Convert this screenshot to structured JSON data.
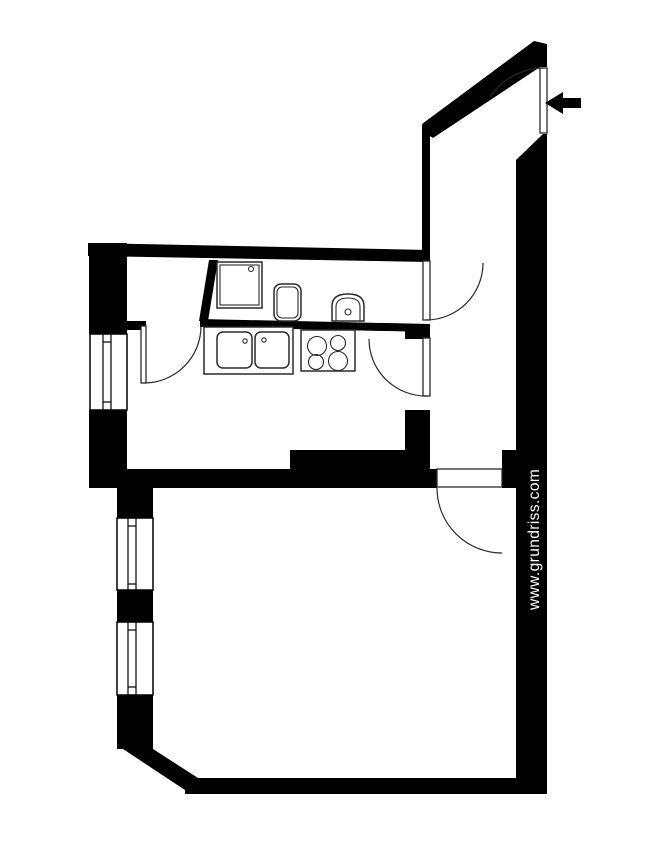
{
  "colors": {
    "wall": "#000000",
    "line": "#2a2a2a",
    "background": "#ffffff",
    "watermark": "#ffffff"
  },
  "watermark": {
    "text": "www.grundriss.com"
  },
  "canvas": {
    "width": 650,
    "height": 856
  },
  "shapes": [
    {
      "name": "top-wall",
      "type": "polygon",
      "cls": "wall",
      "attrs": {
        "points": "88,243 430,250 430,262 88,256"
      }
    },
    {
      "name": "left-wall-upper",
      "type": "rect",
      "cls": "wall",
      "attrs": {
        "x": 89,
        "y": 243,
        "width": 38,
        "height": 91
      }
    },
    {
      "name": "left-wall-mid",
      "type": "rect",
      "cls": "wall",
      "attrs": {
        "x": 89,
        "y": 410,
        "width": 38,
        "height": 78
      }
    },
    {
      "name": "pantry-bottom-wall",
      "type": "rect",
      "cls": "wall",
      "attrs": {
        "x": 117,
        "y": 321,
        "width": 29,
        "height": 9
      }
    },
    {
      "name": "bath-kitchen-wall",
      "type": "polygon",
      "cls": "wall",
      "attrs": {
        "points": "200,319 430,324 430,332 200,327"
      }
    },
    {
      "name": "pantry-bath-divider",
      "type": "polygon",
      "cls": "wall",
      "attrs": {
        "points": "209,260 218,260 208,321 199,321"
      }
    },
    {
      "name": "hall-left-wall",
      "type": "rect",
      "cls": "wall",
      "attrs": {
        "x": 422,
        "y": 125,
        "width": 8,
        "height": 127
      }
    },
    {
      "name": "hall-mid-stub",
      "type": "rect",
      "cls": "wall",
      "attrs": {
        "x": 405,
        "y": 325,
        "width": 25,
        "height": 14
      }
    },
    {
      "name": "kitchen-hall-wall",
      "type": "rect",
      "cls": "wall",
      "attrs": {
        "x": 405,
        "y": 410,
        "width": 25,
        "height": 60
      }
    },
    {
      "name": "chimney-block",
      "type": "rect",
      "cls": "wall",
      "attrs": {
        "x": 290,
        "y": 450,
        "width": 140,
        "height": 20
      }
    },
    {
      "name": "room-top-wall",
      "type": "rect",
      "cls": "wall",
      "attrs": {
        "x": 117,
        "y": 469,
        "width": 320,
        "height": 19
      }
    },
    {
      "name": "room-door-right-stub",
      "type": "rect",
      "cls": "wall",
      "attrs": {
        "x": 502,
        "y": 450,
        "width": 14,
        "height": 38
      }
    },
    {
      "name": "right-wall",
      "type": "polygon",
      "cls": "wall",
      "attrs": {
        "points": "543,134 547,134 547,793 516,793 516,160"
      }
    },
    {
      "name": "diagonal-entrance-wall",
      "type": "polygon",
      "cls": "wall",
      "attrs": {
        "points": "534,41 547,44 547,67 540,67 433,138 422,131 422,124"
      }
    },
    {
      "name": "room-left-wall",
      "type": "rect",
      "cls": "wall",
      "attrs": {
        "x": 117,
        "y": 469,
        "width": 36,
        "height": 280
      }
    },
    {
      "name": "chamfer-wall",
      "type": "polygon",
      "cls": "wall",
      "attrs": {
        "points": "117,736 153,736 153,749 198,778 191,794 117,745"
      }
    },
    {
      "name": "bottom-wall",
      "type": "rect",
      "cls": "wall",
      "attrs": {
        "x": 185,
        "y": 778,
        "width": 362,
        "height": 16
      }
    },
    {
      "name": "kitchen-window-frame",
      "type": "rect",
      "cls": "win",
      "attrs": {
        "x": 90,
        "y": 334,
        "width": 37,
        "height": 76
      }
    },
    {
      "name": "kitchen-window-pane-1",
      "type": "line",
      "cls": "wline",
      "attrs": {
        "x1": 103,
        "y1": 334,
        "x2": 103,
        "y2": 410
      }
    },
    {
      "name": "kitchen-window-pane-2",
      "type": "line",
      "cls": "wline",
      "attrs": {
        "x1": 111,
        "y1": 334,
        "x2": 111,
        "y2": 410
      }
    },
    {
      "name": "kitchen-window-tick-1",
      "type": "line",
      "cls": "wline",
      "attrs": {
        "x1": 103,
        "y1": 342,
        "x2": 111,
        "y2": 342
      }
    },
    {
      "name": "kitchen-window-tick-2",
      "type": "line",
      "cls": "wline",
      "attrs": {
        "x1": 103,
        "y1": 402,
        "x2": 111,
        "y2": 402
      }
    },
    {
      "name": "room-window-1-frame",
      "type": "rect",
      "cls": "win",
      "attrs": {
        "x": 117,
        "y": 518,
        "width": 36,
        "height": 72
      }
    },
    {
      "name": "room-window-1-pane-1",
      "type": "line",
      "cls": "wline",
      "attrs": {
        "x1": 128,
        "y1": 518,
        "x2": 128,
        "y2": 590
      }
    },
    {
      "name": "room-window-1-pane-2",
      "type": "line",
      "cls": "wline",
      "attrs": {
        "x1": 136,
        "y1": 518,
        "x2": 136,
        "y2": 590
      }
    },
    {
      "name": "room-window-1-tick-1",
      "type": "line",
      "cls": "wline",
      "attrs": {
        "x1": 128,
        "y1": 526,
        "x2": 136,
        "y2": 526
      }
    },
    {
      "name": "room-window-1-tick-2",
      "type": "line",
      "cls": "wline",
      "attrs": {
        "x1": 128,
        "y1": 584,
        "x2": 136,
        "y2": 584
      }
    },
    {
      "name": "room-window-2-frame",
      "type": "rect",
      "cls": "win",
      "attrs": {
        "x": 117,
        "y": 622,
        "width": 36,
        "height": 73
      }
    },
    {
      "name": "room-window-2-pane-1",
      "type": "line",
      "cls": "wline",
      "attrs": {
        "x1": 128,
        "y1": 622,
        "x2": 128,
        "y2": 695
      }
    },
    {
      "name": "room-window-2-pane-2",
      "type": "line",
      "cls": "wline",
      "attrs": {
        "x1": 136,
        "y1": 622,
        "x2": 136,
        "y2": 695
      }
    },
    {
      "name": "room-window-2-tick-1",
      "type": "line",
      "cls": "wline",
      "attrs": {
        "x1": 128,
        "y1": 630,
        "x2": 136,
        "y2": 630
      }
    },
    {
      "name": "room-window-2-tick-2",
      "type": "line",
      "cls": "wline",
      "attrs": {
        "x1": 128,
        "y1": 687,
        "x2": 136,
        "y2": 687
      }
    },
    {
      "name": "entrance-door-leaf",
      "type": "rect",
      "cls": "leaf",
      "attrs": {
        "x": 540,
        "y": 68,
        "width": 7,
        "height": 65
      }
    },
    {
      "name": "entrance-door-arc",
      "type": "path",
      "cls": "arc",
      "attrs": {
        "d": "M543,68 A65,65 0 0 0 490,97"
      }
    },
    {
      "name": "bath-door-leaf",
      "type": "rect",
      "cls": "leaf",
      "attrs": {
        "x": 423,
        "y": 261,
        "width": 7,
        "height": 59
      }
    },
    {
      "name": "bath-door-arc",
      "type": "path",
      "cls": "arc",
      "attrs": {
        "d": "M426,320 A57,57 0 0 0 483,263"
      }
    },
    {
      "name": "kitchen-door-leaf",
      "type": "rect",
      "cls": "leaf",
      "attrs": {
        "x": 423,
        "y": 338,
        "width": 7,
        "height": 58
      }
    },
    {
      "name": "kitchen-door-arc",
      "type": "path",
      "cls": "arc",
      "attrs": {
        "d": "M426,396 A57,57 0 0 1 369,339"
      }
    },
    {
      "name": "pantry-door-leaf",
      "type": "rect",
      "cls": "leaf",
      "attrs": {
        "x": 141,
        "y": 326,
        "width": 5,
        "height": 57
      }
    },
    {
      "name": "pantry-door-arc",
      "type": "path",
      "cls": "arc",
      "attrs": {
        "d": "M144,383 A57,57 0 0 0 201,326"
      }
    },
    {
      "name": "room-door-leaf",
      "type": "rect",
      "cls": "leaf",
      "attrs": {
        "x": 437,
        "y": 469,
        "width": 65,
        "height": 18
      }
    },
    {
      "name": "room-door-arc",
      "type": "path",
      "cls": "arc",
      "attrs": {
        "d": "M437,488 A65,65 0 0 0 502,553"
      }
    },
    {
      "name": "shower-tray-outer",
      "type": "rect",
      "cls": "fix",
      "attrs": {
        "x": 217,
        "y": 262,
        "width": 45,
        "height": 46
      }
    },
    {
      "name": "shower-tray-inner",
      "type": "rect",
      "cls": "fixthin",
      "attrs": {
        "x": 220,
        "y": 265,
        "width": 39,
        "height": 40
      }
    },
    {
      "name": "shower-drain",
      "type": "circle",
      "cls": "fixthin",
      "attrs": {
        "cx": 251,
        "cy": 269,
        "r": 2.5
      }
    },
    {
      "name": "washbasin-outer",
      "type": "rect",
      "cls": "fix",
      "attrs": {
        "x": 274,
        "y": 284,
        "width": 27,
        "height": 37,
        "rx": 7
      }
    },
    {
      "name": "washbasin-inner",
      "type": "rect",
      "cls": "fixthin",
      "attrs": {
        "x": 277,
        "y": 287,
        "width": 21,
        "height": 31,
        "rx": 5
      }
    },
    {
      "name": "wc-bowl-outer",
      "type": "path",
      "cls": "fix",
      "attrs": {
        "d": "M332,321 L332,306 Q332,294 348,294 Q364,294 364,306 L364,321 Z"
      }
    },
    {
      "name": "wc-bowl-inner",
      "type": "path",
      "cls": "fixthin",
      "attrs": {
        "d": "M336,321 L336,307 Q336,298 348,298 Q360,298 360,307 L360,321 Z"
      }
    },
    {
      "name": "wc-drain",
      "type": "circle",
      "cls": "fixthin",
      "attrs": {
        "cx": 348,
        "cy": 312,
        "r": 3
      }
    },
    {
      "name": "kitchen-counter",
      "type": "rect",
      "cls": "fix",
      "attrs": {
        "x": 204,
        "y": 327,
        "width": 89,
        "height": 47
      }
    },
    {
      "name": "sink-left",
      "type": "rect",
      "cls": "fix",
      "attrs": {
        "x": 217,
        "y": 332,
        "width": 35,
        "height": 36,
        "rx": 6
      }
    },
    {
      "name": "sink-left-tap",
      "type": "circle",
      "cls": "fixthin",
      "attrs": {
        "cx": 245,
        "cy": 341,
        "r": 2.2
      }
    },
    {
      "name": "sink-right",
      "type": "rect",
      "cls": "fix",
      "attrs": {
        "x": 255,
        "y": 332,
        "width": 34,
        "height": 36,
        "rx": 6
      }
    },
    {
      "name": "sink-right-tap",
      "type": "circle",
      "cls": "fixthin",
      "attrs": {
        "cx": 264,
        "cy": 340,
        "r": 2.2
      }
    },
    {
      "name": "stove",
      "type": "rect",
      "cls": "fix",
      "attrs": {
        "x": 301,
        "y": 330,
        "width": 54,
        "height": 41
      }
    },
    {
      "name": "stove-burner-tl",
      "type": "circle",
      "cls": "fixthin",
      "attrs": {
        "cx": 317,
        "cy": 346,
        "r": 9.5
      }
    },
    {
      "name": "stove-burner-tr",
      "type": "circle",
      "cls": "fixthin",
      "attrs": {
        "cx": 338,
        "cy": 343,
        "r": 7.5
      }
    },
    {
      "name": "stove-burner-bl",
      "type": "circle",
      "cls": "fixthin",
      "attrs": {
        "cx": 316,
        "cy": 362,
        "r": 7.5
      }
    },
    {
      "name": "stove-burner-br",
      "type": "circle",
      "cls": "fixthin",
      "attrs": {
        "cx": 338,
        "cy": 361,
        "r": 9.5
      }
    },
    {
      "name": "entrance-arrow-head",
      "type": "polygon",
      "cls": "wall",
      "attrs": {
        "points": "545,103 563,92 563,114"
      }
    },
    {
      "name": "entrance-arrow-shaft",
      "type": "rect",
      "cls": "wall",
      "attrs": {
        "x": 563,
        "y": 98,
        "width": 18,
        "height": 10
      }
    }
  ]
}
